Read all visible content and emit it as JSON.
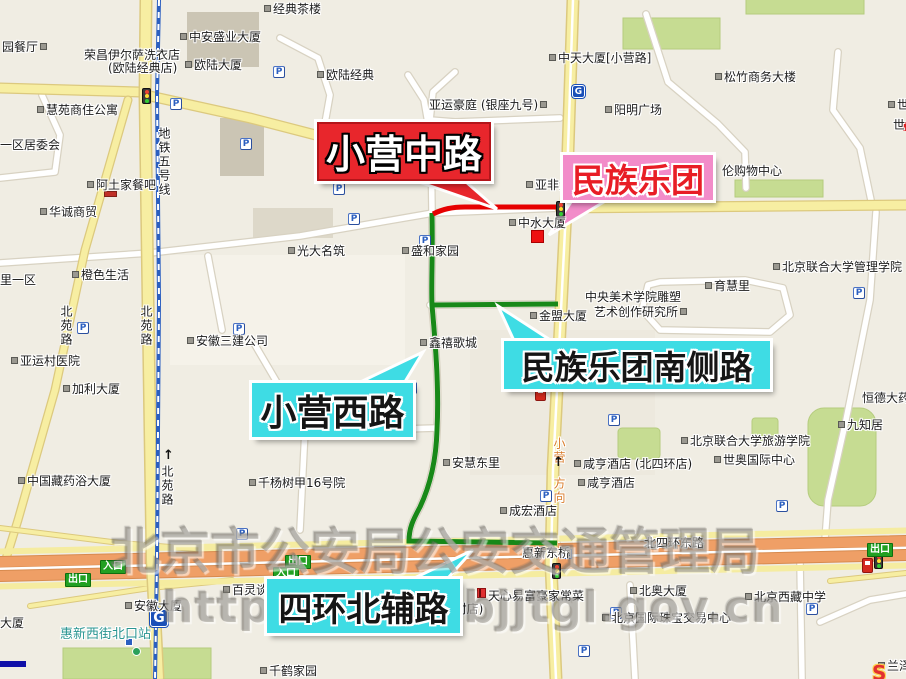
{
  "callouts": [
    {
      "id": "xiaoying-middle-road",
      "text": "小营中路",
      "style": "red"
    },
    {
      "id": "minzu-orchestra",
      "text": "民族乐团",
      "style": "pink"
    },
    {
      "id": "minzu-orchestra-south-road",
      "text": "民族乐团南侧路",
      "style": "cyan"
    },
    {
      "id": "xiaoying-west-road",
      "text": "小营西路",
      "style": "cyan"
    },
    {
      "id": "fourth-ring-north-aux-road",
      "text": "四环北辅路",
      "style": "cyan"
    }
  ],
  "watermark": {
    "line1": "北京市公安局公安交通管理局",
    "line2": "http://www.bjjtgl.gov.cn"
  },
  "colors": {
    "red_callout": "#E8262C",
    "pink_callout": "#F28CC9",
    "cyan_callout": "#3EDCE4",
    "route_red": "#E60000",
    "route_green": "#188818",
    "highway_orange": "#EF9F66",
    "road_yellow": "#F7EEA2",
    "park_green": "#C6DC92",
    "metro_blue": "#2B5FC0",
    "station_teal": "#2A9591",
    "direction_orange": "#D97B29"
  },
  "labels": [
    {
      "text": "经典茶楼",
      "x": 262,
      "y": 3,
      "m": "l"
    },
    {
      "text": "园餐厅",
      "x": 2,
      "y": 41,
      "m": "r"
    },
    {
      "text": "中安盛业大厦",
      "x": 178,
      "y": 31,
      "m": "l"
    },
    {
      "text": "荣昌伊尔萨洗衣店",
      "x": 84,
      "y": 49
    },
    {
      "text": "(欧陆经典店)",
      "x": 108,
      "y": 62
    },
    {
      "text": "欧陆大厦",
      "x": 183,
      "y": 59,
      "m": "l"
    },
    {
      "text": "欧陆经典",
      "x": 315,
      "y": 69,
      "m": "l"
    },
    {
      "text": "亚运豪庭 (银座九号)",
      "x": 429,
      "y": 99,
      "m": "r"
    },
    {
      "text": "中天大厦[小营路]",
      "x": 547,
      "y": 52,
      "m": "l"
    },
    {
      "text": "松竹商务大楼",
      "x": 713,
      "y": 71,
      "m": "l"
    },
    {
      "text": "阳明广场",
      "x": 603,
      "y": 104,
      "m": "l"
    },
    {
      "text": "世纪",
      "x": 886,
      "y": 99,
      "m": "l"
    },
    {
      "text": "世",
      "x": 893,
      "y": 119
    },
    {
      "text": "慧苑商住公寓",
      "x": 35,
      "y": 104,
      "m": "l"
    },
    {
      "text": "一区居委会",
      "x": 0,
      "y": 139
    },
    {
      "text": "阿土家餐吧",
      "x": 85,
      "y": 179,
      "m": "l"
    },
    {
      "text": "华诚商贸",
      "x": 38,
      "y": 206,
      "m": "l"
    },
    {
      "text": "橙色生活",
      "x": 70,
      "y": 269,
      "m": "l"
    },
    {
      "text": "里一区",
      "x": 0,
      "y": 274
    },
    {
      "text": "光大名筑",
      "x": 286,
      "y": 245,
      "m": "l"
    },
    {
      "text": "盛和家园",
      "x": 400,
      "y": 245,
      "m": "l"
    },
    {
      "text": "中水大厦",
      "x": 507,
      "y": 217,
      "m": "l"
    },
    {
      "text": "亚非大厦",
      "x": 524,
      "y": 179,
      "m": "l"
    },
    {
      "text": "伦购物中心",
      "x": 722,
      "y": 165
    },
    {
      "text": "中央美术学院雕塑",
      "x": 585,
      "y": 291
    },
    {
      "text": "艺术创作研究所",
      "x": 594,
      "y": 306,
      "m": "r"
    },
    {
      "text": "金盟大厦",
      "x": 528,
      "y": 310,
      "m": "l"
    },
    {
      "text": "育慧里",
      "x": 703,
      "y": 280,
      "m": "l"
    },
    {
      "text": "北京联合大学管理学院",
      "x": 771,
      "y": 261,
      "m": "l"
    },
    {
      "text": "鑫禧歌城",
      "x": 418,
      "y": 337,
      "m": "l"
    },
    {
      "text": "安徽三建公司",
      "x": 185,
      "y": 335,
      "m": "l"
    },
    {
      "text": "亚运村医院",
      "x": 9,
      "y": 355,
      "m": "l"
    },
    {
      "text": "加利大厦",
      "x": 61,
      "y": 383,
      "m": "l"
    },
    {
      "text": "中国藏药浴大厦",
      "x": 16,
      "y": 475,
      "m": "l"
    },
    {
      "text": "千杨树甲16号院",
      "x": 247,
      "y": 477,
      "m": "l"
    },
    {
      "text": "安慧东里",
      "x": 441,
      "y": 457,
      "m": "l"
    },
    {
      "text": "咸亨酒店 (北四环店)",
      "x": 572,
      "y": 458,
      "m": "l"
    },
    {
      "text": "咸亨酒店",
      "x": 576,
      "y": 477,
      "m": "l"
    },
    {
      "text": "成宏酒店",
      "x": 498,
      "y": 505,
      "m": "l"
    },
    {
      "text": "北京联合大学旅游学院",
      "x": 679,
      "y": 435,
      "m": "l"
    },
    {
      "text": "世奥国际中心",
      "x": 712,
      "y": 454,
      "m": "l"
    },
    {
      "text": "九知居",
      "x": 836,
      "y": 419,
      "m": "l"
    },
    {
      "text": "恒德大药",
      "x": 862,
      "y": 392
    },
    {
      "text": "北四环东路",
      "x": 644,
      "y": 537
    },
    {
      "text": "惠新东桥",
      "x": 522,
      "y": 547
    },
    {
      "text": "天心易富豪家常菜",
      "x": 488,
      "y": 590
    },
    {
      "text": "(村店)",
      "x": 450,
      "y": 603
    },
    {
      "text": "百灵谈保",
      "x": 221,
      "y": 584,
      "m": "l"
    },
    {
      "text": "安徽大厦",
      "x": 123,
      "y": 600,
      "m": "l"
    },
    {
      "text": "惠新西街北口站",
      "x": 60,
      "y": 628,
      "c": "#2A9591",
      "s": 13
    },
    {
      "text": "大厦",
      "x": 0,
      "y": 617
    },
    {
      "text": "千鹤家园",
      "x": 258,
      "y": 665,
      "m": "l"
    },
    {
      "text": "北奥大厦",
      "x": 628,
      "y": 585,
      "m": "l"
    },
    {
      "text": "北京国际珠宝交易中心",
      "x": 600,
      "y": 612,
      "m": "l"
    },
    {
      "text": "北京西藏中学",
      "x": 743,
      "y": 591,
      "m": "l"
    },
    {
      "text": "兰泽宝",
      "x": 876,
      "y": 660,
      "m": "l"
    },
    {
      "text": "地铁五号线",
      "x": 157,
      "y": 127,
      "v": 1
    },
    {
      "text": "北苑路",
      "x": 59,
      "y": 305,
      "v": 1
    },
    {
      "text": "北苑路",
      "x": 139,
      "y": 305,
      "v": 1
    },
    {
      "text": "北苑路",
      "x": 160,
      "y": 465,
      "v": 1
    },
    {
      "text": "小营",
      "x": 552,
      "y": 437,
      "v": 1,
      "c": "#D97B29"
    },
    {
      "text": "方向",
      "x": 552,
      "y": 477,
      "v": 1,
      "c": "#D97B29"
    }
  ],
  "badges": [
    {
      "text": "入口",
      "x": 100,
      "y": 560
    },
    {
      "text": "出口",
      "x": 65,
      "y": 573
    },
    {
      "text": "出口",
      "x": 285,
      "y": 555
    },
    {
      "text": "入口",
      "x": 273,
      "y": 567
    },
    {
      "text": "出口",
      "x": 867,
      "y": 543
    }
  ],
  "icons": {
    "parking_letter": "P",
    "metro_letter": "G",
    "arrow_char": "↑",
    "soso_logo_text": "S",
    "parking": [
      [
        273,
        66
      ],
      [
        170,
        98
      ],
      [
        240,
        138
      ],
      [
        333,
        183
      ],
      [
        348,
        213
      ],
      [
        419,
        235
      ],
      [
        77,
        322
      ],
      [
        233,
        323
      ],
      [
        853,
        287
      ],
      [
        608,
        414
      ],
      [
        776,
        500
      ],
      [
        540,
        490
      ],
      [
        236,
        528
      ],
      [
        610,
        607
      ],
      [
        806,
        603
      ],
      [
        578,
        645
      ],
      [
        405,
        382
      ]
    ],
    "traffic_lights": [
      [
        142,
        88
      ],
      [
        556,
        201
      ],
      [
        552,
        563
      ],
      [
        874,
        553
      ]
    ],
    "metro_logos": [
      [
        572,
        85,
        13
      ],
      [
        150,
        609,
        18
      ]
    ],
    "gas_stations": [
      [
        535,
        386
      ],
      [
        862,
        558
      ]
    ],
    "arrows": [
      [
        163,
        449
      ],
      [
        553,
        456
      ]
    ]
  }
}
